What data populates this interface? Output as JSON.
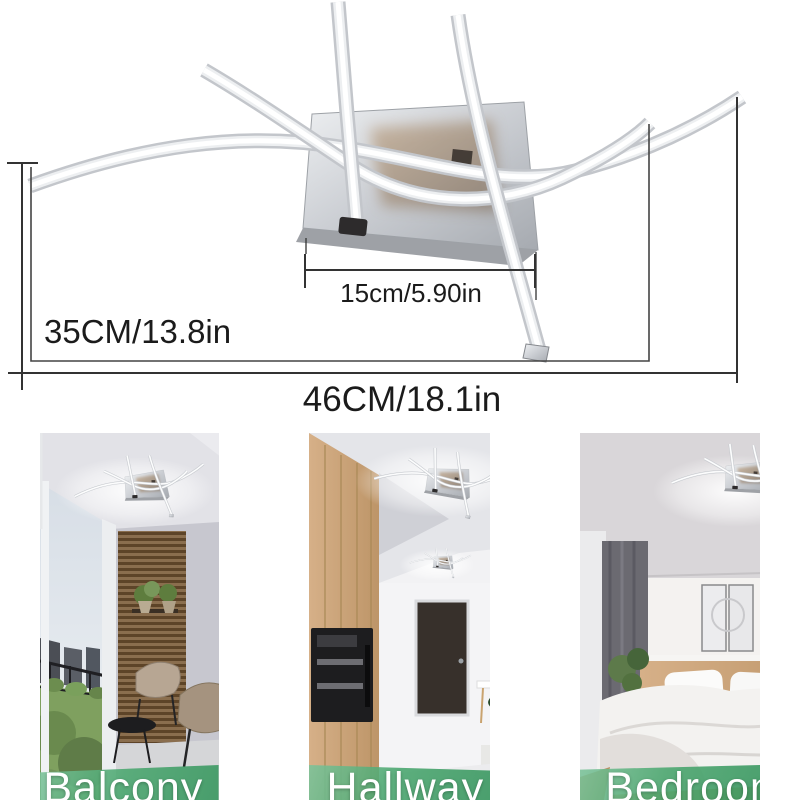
{
  "diagram": {
    "dimensions": {
      "base": "15cm/5.90in",
      "height": "35CM/13.8in",
      "width": "46CM/18.1in"
    }
  },
  "gallery": {
    "photos": [
      {
        "label": "Balcony"
      },
      {
        "label": "Hallway"
      },
      {
        "label": "Bedroom"
      }
    ],
    "band_color": "#49a66e",
    "label_text_color": "#ffffff"
  },
  "colors": {
    "dimension_line": "#333333",
    "chrome_light": "#eef0f2",
    "chrome_dark": "#a6aab0",
    "led_bar_edge": "#c3c6cb",
    "led_bar_core": "#ffffff",
    "background": "#ffffff"
  }
}
